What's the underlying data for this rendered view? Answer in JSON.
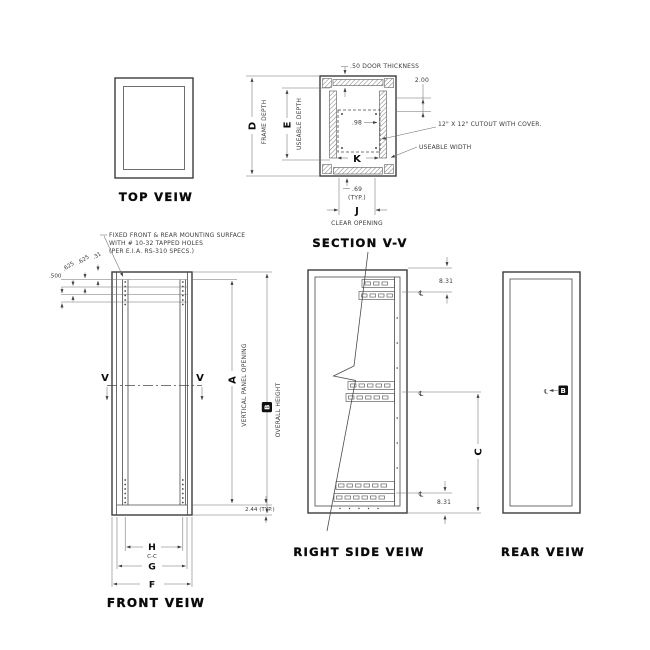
{
  "page": {
    "paper": "#ffffff",
    "ink": "#3f3f3f",
    "heavy_ink": "#0a0a0a"
  },
  "views": {
    "top": {
      "title": "TOP VEIW"
    },
    "section_vv": {
      "title": "SECTION V-V",
      "door_thickness": ".50 DOOR THICKNESS",
      "frame_depth_letter": "D",
      "frame_depth_label": "FRAME DEPTH",
      "useable_depth_letter": "E",
      "useable_depth_label": "USEABLE DEPTH",
      "dim_top_offset": "2.00",
      "dim_cutout_offset": ".98",
      "cutout_note": "12\" X 12\" CUTOUT WITH COVER.",
      "useable_width_label": "USEABLE WIDTH",
      "useable_width_letter": "K",
      "dim_foot": ".69",
      "dim_foot_typ": "(TYP.)",
      "clear_opening_letter": "J",
      "clear_opening_label": "CLEAR OPENING"
    },
    "front": {
      "title": "FRONT VEIW",
      "note1": "FIXED FRONT & REAR MOUNTING SURFACE",
      "note2": "WITH # 10-32 TAPPED HOLES",
      "note3": "(PER E.I.A. RS-310 SPECS.)",
      "dim_500": ".500",
      "dim_625a": ".625",
      "dim_625b": ".625",
      "dim_31": ".31",
      "section_cut": "V",
      "panel_opening_letter": "A",
      "panel_opening_label": "VERTICAL PANEL OPENING",
      "overall_height_letter": "B",
      "overall_height_label": "OVERALL HEIGHT",
      "dim_margin": "2.44 (TYP.)",
      "dim_h": "H",
      "dim_h_sub": "C-C",
      "dim_g": "G",
      "dim_f": "F"
    },
    "right_side": {
      "title": "RIGHT SIDE VEIW",
      "dim_top": "8.31",
      "dim_bottom": "8.31",
      "dim_c": "C",
      "centerline": "℄"
    },
    "rear": {
      "title": "REAR VEIW",
      "centerline": "℄",
      "ref_b": "B"
    }
  }
}
